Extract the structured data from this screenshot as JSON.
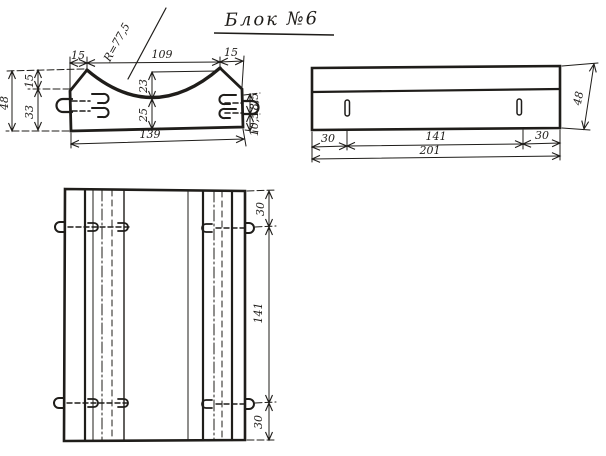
{
  "title": "Блок №6",
  "colors": {
    "ink": "#1f1d1a",
    "paper": "#ffffff"
  },
  "front_view": {
    "label": "front-view-with-curved-top",
    "dims": {
      "top_left_chamfer": "15",
      "top_opening": "109",
      "top_right_chamfer": "15",
      "bottom_width": "139",
      "total_height": "48",
      "left_upper": "15",
      "left_lower": "33",
      "curve_depth": "23",
      "height_under_curve": "25",
      "radius": "R=77,5",
      "right_upper": "18,5",
      "right_lower": "10,5"
    }
  },
  "side_view": {
    "label": "side-elevation",
    "dims": {
      "left_offset": "30",
      "middle_span": "141",
      "right_offset": "30",
      "total_length": "201",
      "height": "48"
    }
  },
  "plan_view": {
    "label": "plan-view",
    "dims": {
      "top_offset": "30",
      "middle_span": "141",
      "bottom_offset": "30"
    }
  }
}
